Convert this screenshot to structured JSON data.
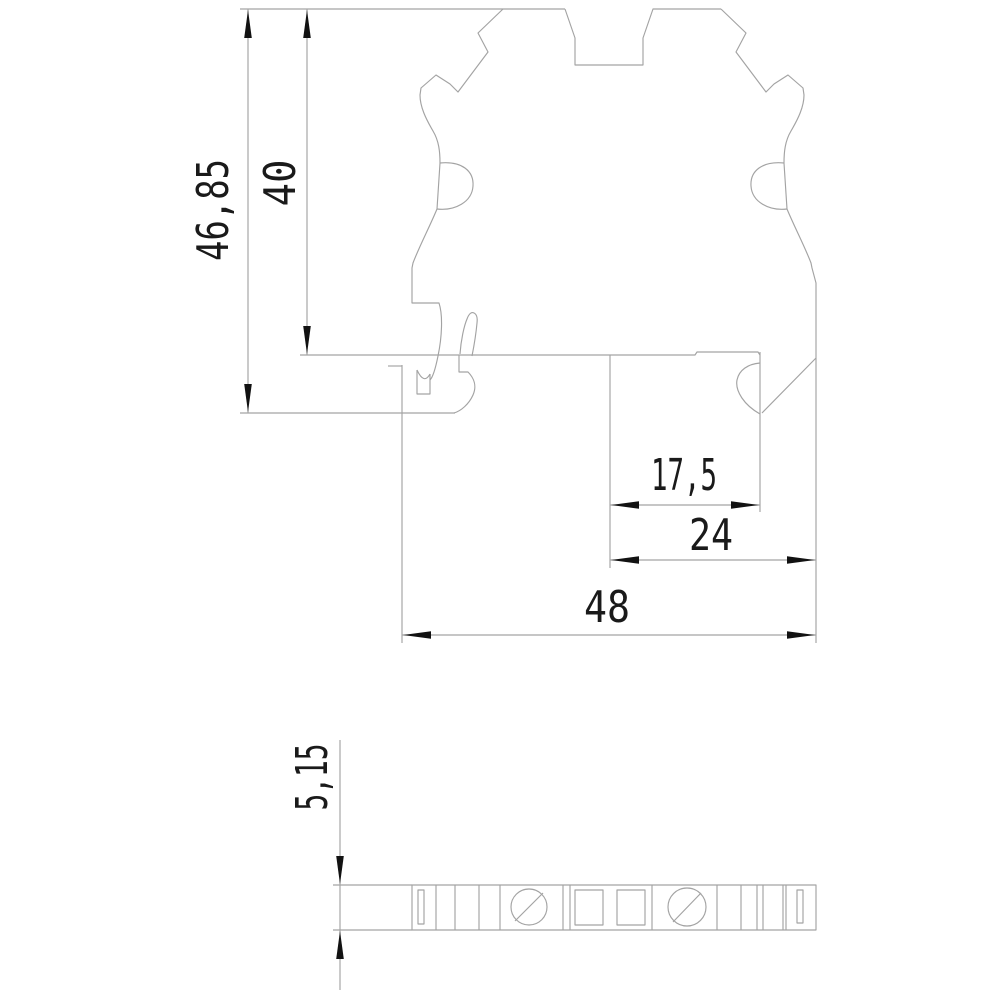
{
  "dimensions": {
    "overall_height": "46,85",
    "body_height": "40",
    "rail_notch_offset": "17,5",
    "base_width": "24",
    "overall_width": "48",
    "strip_thickness": "5,15"
  },
  "colors": {
    "line": "#a3a3a3",
    "arrow": "#121212",
    "text": "#1a1a1a",
    "background": "#ffffff"
  }
}
